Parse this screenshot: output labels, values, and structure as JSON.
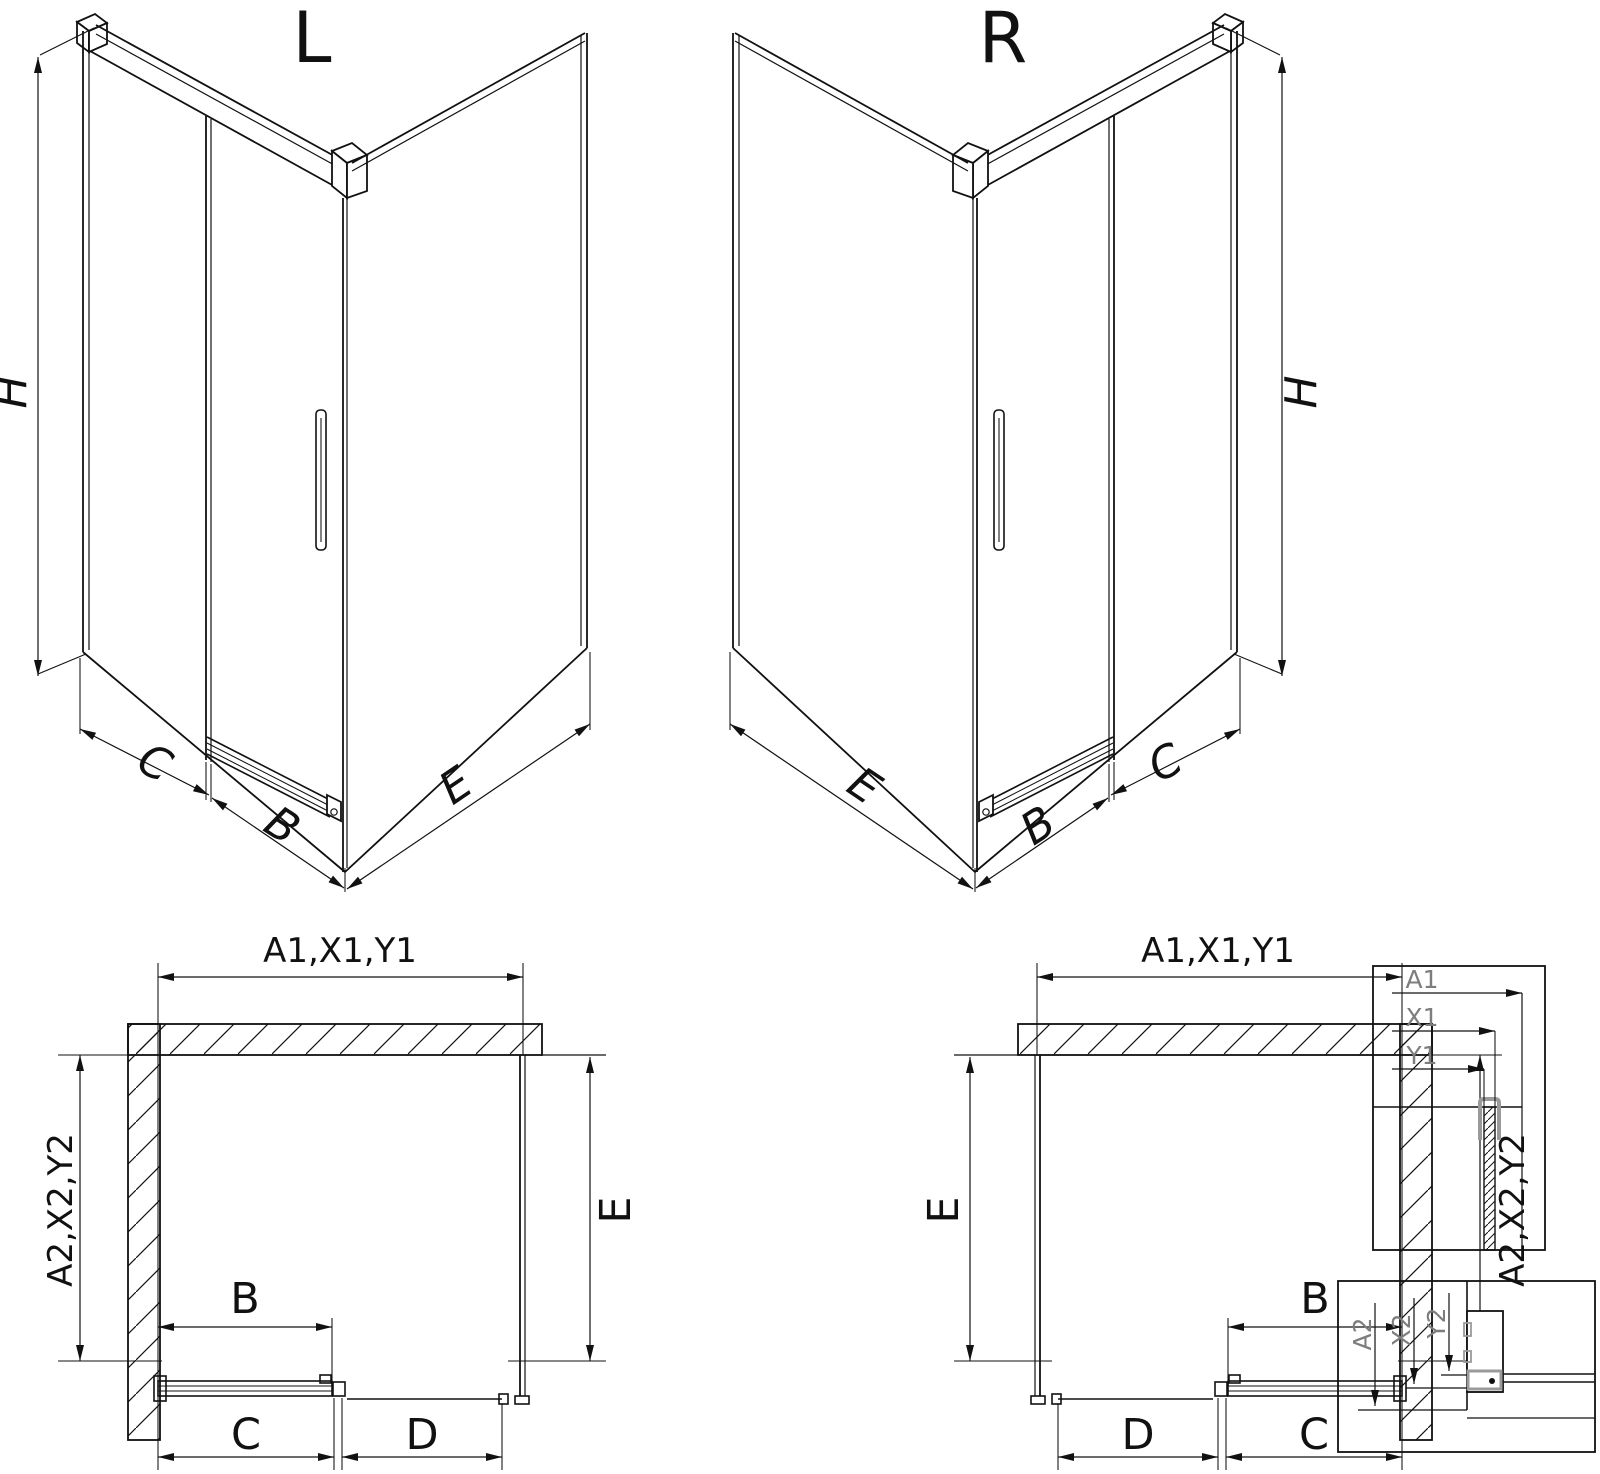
{
  "diagram": {
    "variants": [
      {
        "title": "L",
        "height_label": "H",
        "base_labels": {
          "left": "C",
          "middle": "B",
          "right": "E"
        }
      },
      {
        "title": "R",
        "height_label": "H",
        "base_labels": {
          "left": "E",
          "middle": "B",
          "right": "C"
        }
      }
    ],
    "plans": [
      {
        "width_label": "A1,X1,Y1",
        "depth_label": "A2,X2,Y2",
        "side_label": "E",
        "door_label": "B",
        "bottom_left_label": "C",
        "bottom_right_label": "D"
      },
      {
        "width_label": "A1,X1,Y1",
        "depth_label": "A2,X2,Y2",
        "side_label": "E",
        "door_label": "B",
        "bottom_left_label": "D",
        "bottom_right_label": "C"
      }
    ],
    "details": [
      {
        "labels": [
          "A1",
          "X1",
          "Y1"
        ]
      },
      {
        "labels": [
          "A2",
          "X2",
          "Y2"
        ]
      }
    ],
    "colors": {
      "line": "#111111",
      "detail_label": "#7d7d7d",
      "hardware_gray": "#9a9a9a",
      "background": "#ffffff"
    }
  }
}
